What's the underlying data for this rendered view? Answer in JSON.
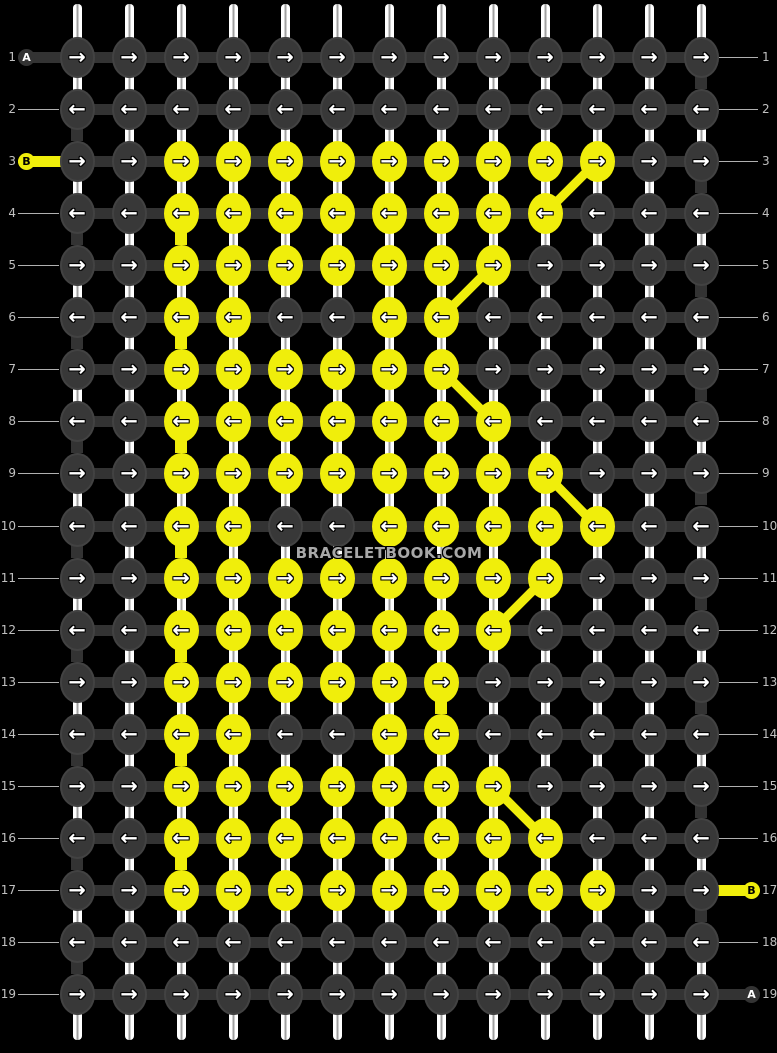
{
  "pattern": {
    "site_watermark": "BRACELETBOOK.COM",
    "threads": [
      {
        "id": "A",
        "color": "#383838",
        "label_text_color": "#ffffff",
        "capsule_color": "#333333"
      },
      {
        "id": "B",
        "color": "#f0ee0b",
        "label_text_color": "#000000",
        "capsule_color": "#f0ee0b"
      }
    ],
    "grid": {
      "columns": 13,
      "rows": [
        {
          "number": 1,
          "direction": "right",
          "knots": [
            "A",
            "A",
            "A",
            "A",
            "A",
            "A",
            "A",
            "A",
            "A",
            "A",
            "A",
            "A",
            "A"
          ]
        },
        {
          "number": 2,
          "direction": "left",
          "knots": [
            "A",
            "A",
            "A",
            "A",
            "A",
            "A",
            "A",
            "A",
            "A",
            "A",
            "A",
            "A",
            "A"
          ]
        },
        {
          "number": 3,
          "direction": "right",
          "knots": [
            "A",
            "A",
            "B",
            "B",
            "B",
            "B",
            "B",
            "B",
            "B",
            "B",
            "B",
            "A",
            "A"
          ]
        },
        {
          "number": 4,
          "direction": "left",
          "knots": [
            "A",
            "A",
            "B",
            "B",
            "B",
            "B",
            "B",
            "B",
            "B",
            "B",
            "A",
            "A",
            "A"
          ]
        },
        {
          "number": 5,
          "direction": "right",
          "knots": [
            "A",
            "A",
            "B",
            "B",
            "B",
            "B",
            "B",
            "B",
            "B",
            "A",
            "A",
            "A",
            "A"
          ]
        },
        {
          "number": 6,
          "direction": "left",
          "knots": [
            "A",
            "A",
            "B",
            "B",
            "A",
            "A",
            "B",
            "B",
            "A",
            "A",
            "A",
            "A",
            "A"
          ]
        },
        {
          "number": 7,
          "direction": "right",
          "knots": [
            "A",
            "A",
            "B",
            "B",
            "B",
            "B",
            "B",
            "B",
            "A",
            "A",
            "A",
            "A",
            "A"
          ]
        },
        {
          "number": 8,
          "direction": "left",
          "knots": [
            "A",
            "A",
            "B",
            "B",
            "B",
            "B",
            "B",
            "B",
            "B",
            "A",
            "A",
            "A",
            "A"
          ]
        },
        {
          "number": 9,
          "direction": "right",
          "knots": [
            "A",
            "A",
            "B",
            "B",
            "B",
            "B",
            "B",
            "B",
            "B",
            "B",
            "A",
            "A",
            "A"
          ]
        },
        {
          "number": 10,
          "direction": "left",
          "knots": [
            "A",
            "A",
            "B",
            "B",
            "A",
            "A",
            "B",
            "B",
            "B",
            "B",
            "B",
            "A",
            "A"
          ]
        },
        {
          "number": 11,
          "direction": "right",
          "knots": [
            "A",
            "A",
            "B",
            "B",
            "B",
            "B",
            "B",
            "B",
            "B",
            "B",
            "A",
            "A",
            "A"
          ]
        },
        {
          "number": 12,
          "direction": "left",
          "knots": [
            "A",
            "A",
            "B",
            "B",
            "B",
            "B",
            "B",
            "B",
            "B",
            "A",
            "A",
            "A",
            "A"
          ]
        },
        {
          "number": 13,
          "direction": "right",
          "knots": [
            "A",
            "A",
            "B",
            "B",
            "B",
            "B",
            "B",
            "B",
            "A",
            "A",
            "A",
            "A",
            "A"
          ]
        },
        {
          "number": 14,
          "direction": "left",
          "knots": [
            "A",
            "A",
            "B",
            "B",
            "A",
            "A",
            "B",
            "B",
            "A",
            "A",
            "A",
            "A",
            "A"
          ]
        },
        {
          "number": 15,
          "direction": "right",
          "knots": [
            "A",
            "A",
            "B",
            "B",
            "B",
            "B",
            "B",
            "B",
            "B",
            "A",
            "A",
            "A",
            "A"
          ]
        },
        {
          "number": 16,
          "direction": "left",
          "knots": [
            "A",
            "A",
            "B",
            "B",
            "B",
            "B",
            "B",
            "B",
            "B",
            "B",
            "A",
            "A",
            "A"
          ]
        },
        {
          "number": 17,
          "direction": "right",
          "knots": [
            "A",
            "A",
            "B",
            "B",
            "B",
            "B",
            "B",
            "B",
            "B",
            "B",
            "B",
            "A",
            "A"
          ]
        },
        {
          "number": 18,
          "direction": "left",
          "knots": [
            "A",
            "A",
            "A",
            "A",
            "A",
            "A",
            "A",
            "A",
            "A",
            "A",
            "A",
            "A",
            "A"
          ]
        },
        {
          "number": 19,
          "direction": "right",
          "knots": [
            "A",
            "A",
            "A",
            "A",
            "A",
            "A",
            "A",
            "A",
            "A",
            "A",
            "A",
            "A",
            "A"
          ]
        }
      ]
    },
    "vertical_segments": {
      "default": "white",
      "dark": [
        [
          1,
          13
        ],
        [
          2,
          1
        ],
        [
          3,
          13
        ],
        [
          4,
          1
        ],
        [
          5,
          13
        ],
        [
          6,
          1
        ],
        [
          7,
          13
        ],
        [
          8,
          1
        ],
        [
          9,
          13
        ],
        [
          10,
          1
        ],
        [
          11,
          13
        ],
        [
          12,
          1
        ],
        [
          13,
          13
        ],
        [
          14,
          1
        ],
        [
          15,
          13
        ],
        [
          16,
          1
        ],
        [
          17,
          13
        ],
        [
          18,
          1
        ]
      ],
      "yellow": [
        [
          4,
          3
        ],
        [
          6,
          3
        ],
        [
          8,
          3
        ],
        [
          10,
          3
        ],
        [
          12,
          3
        ],
        [
          13,
          8
        ],
        [
          14,
          3
        ],
        [
          16,
          3
        ]
      ]
    },
    "diagonals": [
      {
        "from_row": 3,
        "from_col": 11,
        "to_row": 4,
        "to_col": 10
      },
      {
        "from_row": 5,
        "from_col": 9,
        "to_row": 6,
        "to_col": 8
      },
      {
        "from_row": 7,
        "from_col": 8,
        "to_row": 8,
        "to_col": 9
      },
      {
        "from_row": 9,
        "from_col": 10,
        "to_row": 10,
        "to_col": 11
      },
      {
        "from_row": 11,
        "from_col": 10,
        "to_row": 12,
        "to_col": 9
      },
      {
        "from_row": 15,
        "from_col": 9,
        "to_row": 16,
        "to_col": 10
      }
    ],
    "thread_labels": [
      {
        "label": "A",
        "row": 1,
        "side": "left",
        "thread": "A"
      },
      {
        "label": "B",
        "row": 3,
        "side": "left",
        "thread": "B"
      },
      {
        "label": "B",
        "row": 17,
        "side": "right",
        "thread": "B"
      },
      {
        "label": "A",
        "row": 19,
        "side": "right",
        "thread": "A"
      }
    ],
    "arrows": {
      "right": "→",
      "left": "←"
    },
    "colors": {
      "background": "#000000",
      "dark_knot": "#383838",
      "dark_thread": "#333333",
      "yellow_thread": "#f0ee0b",
      "base_string": "#ffffff",
      "base_string_core": "#a0a0a0",
      "row_number": "#c0c0c0",
      "guide_line": "#b0b0b0",
      "watermark_text": "#a8a8a8"
    }
  }
}
